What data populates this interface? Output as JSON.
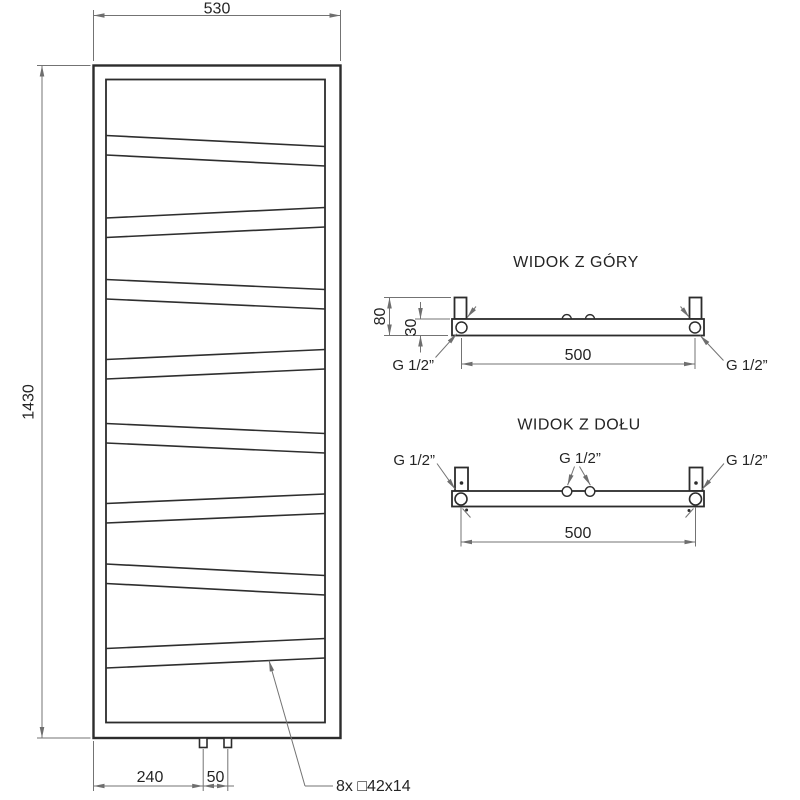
{
  "drawing": {
    "front_view": {
      "width_dim": "530",
      "height_dim": "1430",
      "bottom_offset_dim": "240",
      "pipe_gap_dim": "50",
      "tube_spec": "8x □42x14"
    },
    "top_view": {
      "title": "WIDOK Z GÓRY",
      "depth_dim": "80",
      "collector_depth_dim": "30",
      "connection_spacing_dim": "500",
      "left_connection": "G 1/2”",
      "right_connection": "G 1/2”"
    },
    "bottom_view": {
      "title": "WIDOK Z DOŁU",
      "connection_spacing_dim": "500",
      "left_connection": "G 1/2”",
      "center_connection": "G 1/2”",
      "right_connection": "G 1/2”"
    }
  }
}
